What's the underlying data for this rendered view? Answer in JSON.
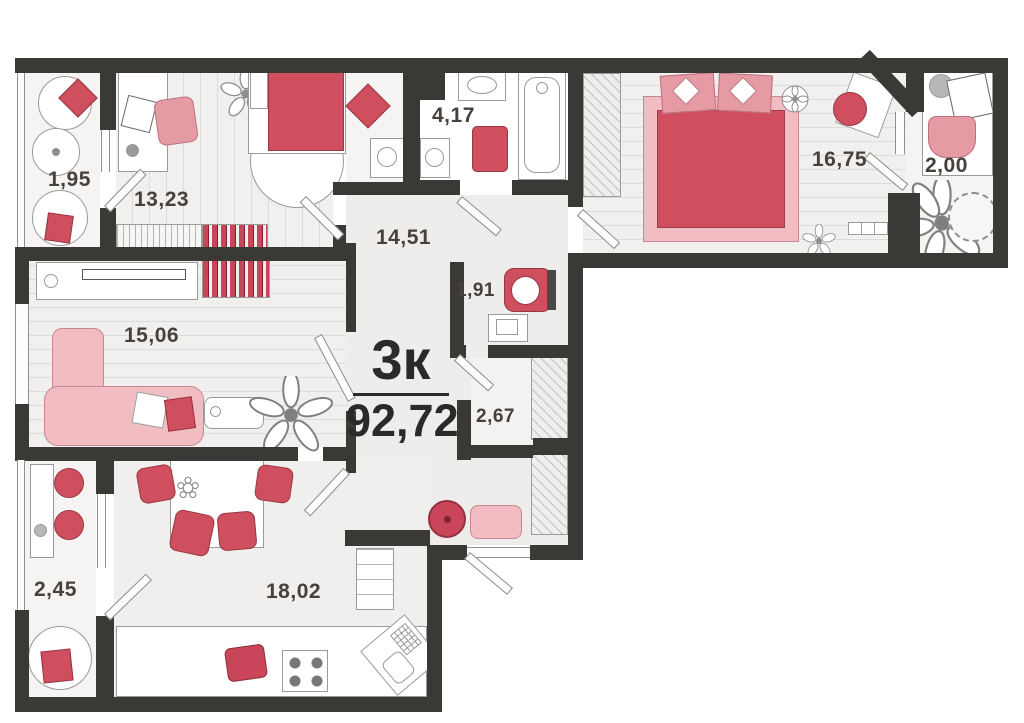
{
  "unit": {
    "type_label": "3к",
    "total_area": "92,72"
  },
  "rooms": [
    {
      "name": "balcony-top-left",
      "area": "1,95"
    },
    {
      "name": "bedroom-small",
      "area": "13,23"
    },
    {
      "name": "bathroom",
      "area": "4,17"
    },
    {
      "name": "hallway",
      "area": "14,51"
    },
    {
      "name": "bedroom-master",
      "area": "16,75"
    },
    {
      "name": "balcony-top-right",
      "area": "2,00"
    },
    {
      "name": "wc",
      "area": "1,91"
    },
    {
      "name": "living-room",
      "area": "15,06"
    },
    {
      "name": "closet",
      "area": "2,67"
    },
    {
      "name": "balcony-bottom-left",
      "area": "2,45"
    },
    {
      "name": "kitchen",
      "area": "18,02"
    }
  ],
  "colors": {
    "wall": "#3b3936",
    "accent_red": "#cf4f5e",
    "accent_pink_light": "#f2bcc3",
    "accent_pink_mid": "#e59aa4",
    "floor": "#f0efee",
    "label_text": "#46423b",
    "title_text": "#2b2a28"
  }
}
